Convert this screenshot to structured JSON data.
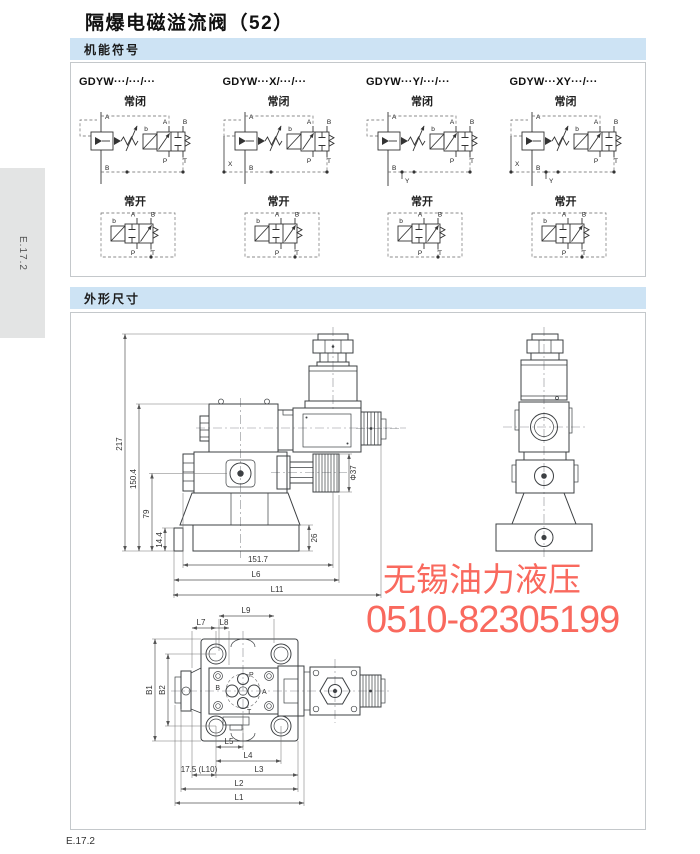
{
  "page": {
    "title": "隔爆电磁溢流阀（52）",
    "side_tab": "E.17.2",
    "footer": "E.17.2"
  },
  "sections": {
    "symbols_header": "机能符号",
    "dims_header": "外形尺寸"
  },
  "symbols": {
    "nc_label": "常闭",
    "no_label": "常开",
    "ports": {
      "a": "A",
      "b": "B",
      "p": "P",
      "t": "T",
      "sol": "b",
      "x": "X",
      "y": "Y"
    },
    "columns": [
      {
        "model": "GDYW···/···/···",
        "has_x": false,
        "has_y": false
      },
      {
        "model": "GDYW···X/···/···",
        "has_x": true,
        "has_y": false
      },
      {
        "model": "GDYW···Y/···/···",
        "has_x": false,
        "has_y": true
      },
      {
        "model": "GDYW···XY···/···",
        "has_x": true,
        "has_y": true
      }
    ]
  },
  "drawing": {
    "front": {
      "h_total": "217",
      "h_upper": "150.4",
      "h_mid": "79",
      "h_base": "14.4",
      "w_body": "151.7",
      "w_l6": "L6",
      "w_l11": "L11",
      "knob_dia": "Φ37",
      "base_h": "26"
    },
    "bottom": {
      "l9": "L9",
      "l7": "L7",
      "l8": "L8",
      "b1": "B1",
      "b2": "B2",
      "l5": "L5",
      "l4": "L4",
      "l10": "17.5 (L10)",
      "l3": "L3",
      "l2": "L2",
      "l1": "L1",
      "ports": {
        "p": "P",
        "b": "B",
        "a": "A",
        "t": "T"
      }
    }
  },
  "watermark": {
    "line1": "无锡油力液压",
    "line2": "0510-82305199",
    "color": "#f9695e"
  },
  "colors": {
    "band_bg": "#cde3f4",
    "box_border": "#c4c8cb",
    "tab_bg": "#e3e4e4",
    "line": "#3d4043",
    "accent_red": "#f9695e"
  }
}
